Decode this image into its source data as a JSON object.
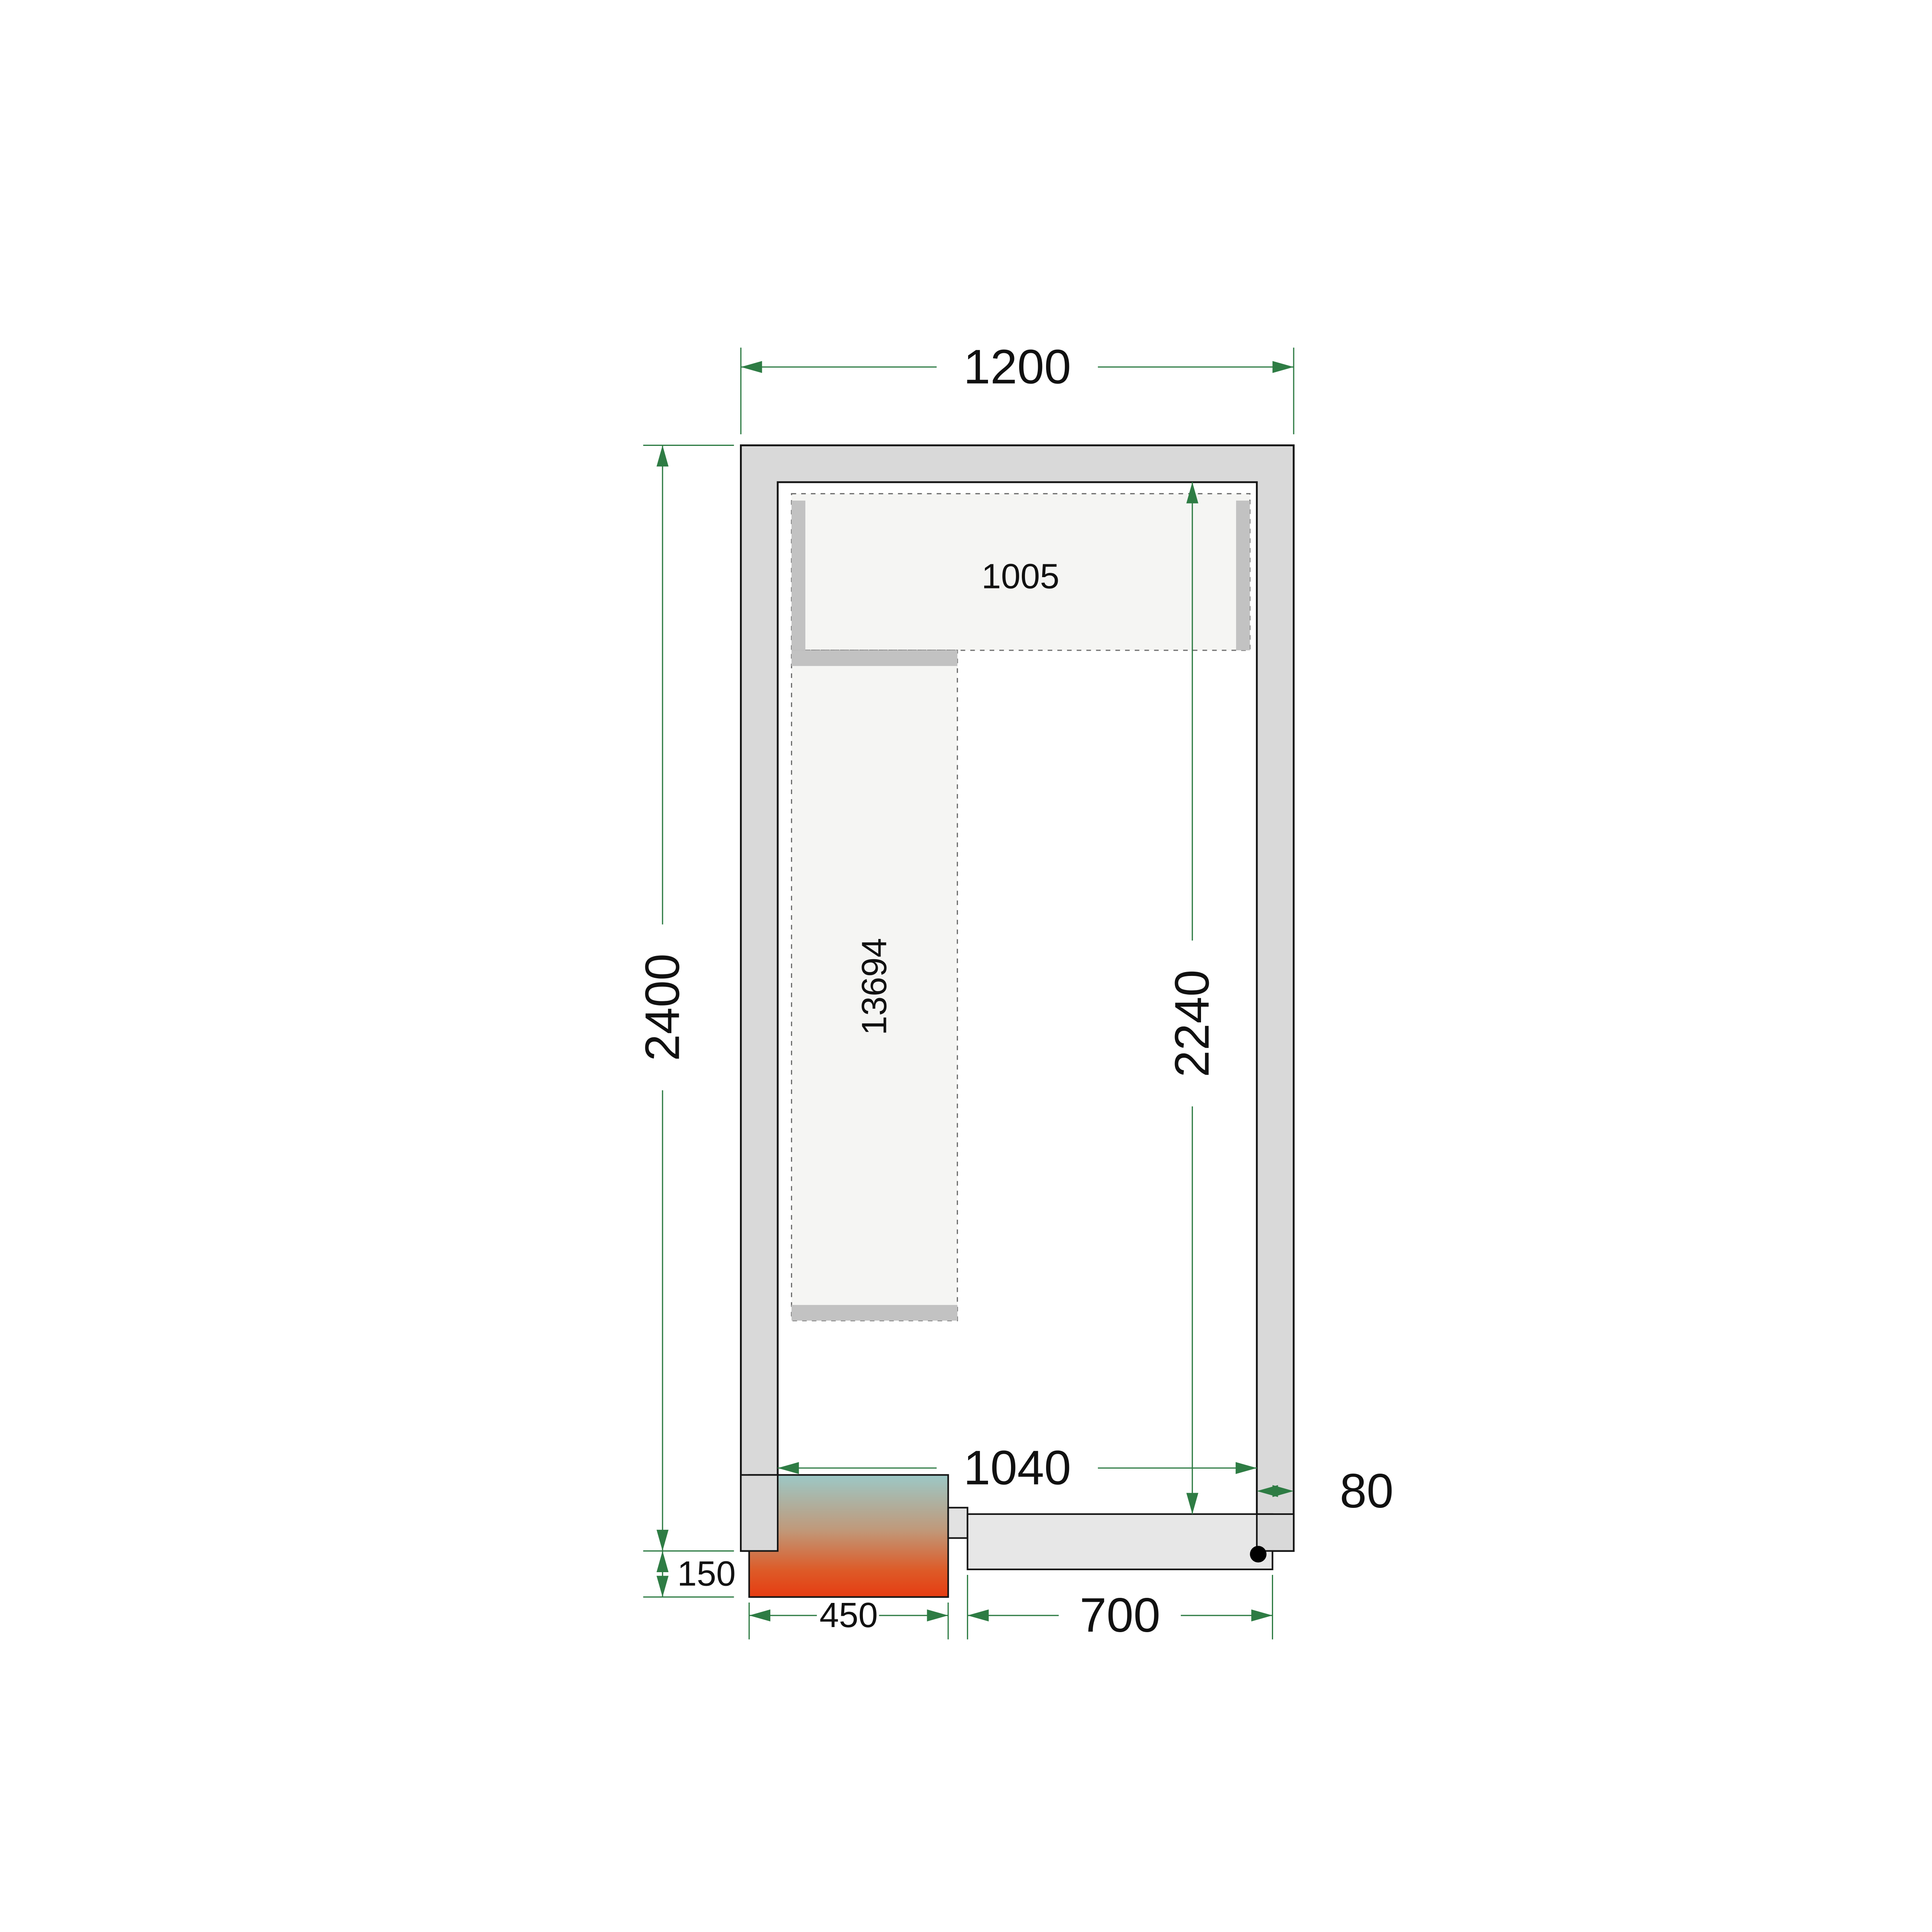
{
  "title": "Cold room floor plan drawing",
  "labels": {
    "outer_width": "1200",
    "outer_height": "2400",
    "inner_height": "2240",
    "inner_width": "1040",
    "top_shelf_width": "1005",
    "left_shelf_code": "13694",
    "cooler_protrusion": "150",
    "cooler_width": "450",
    "door_width": "700",
    "wall_thickness": "80"
  },
  "colors": {
    "dimension_green": "#2E7C44",
    "text": "#111111",
    "outline": "#151515",
    "wall_fill": "#D9D9D9",
    "shelf_fill": "#F5F5F3",
    "shelf_dash": "#6E6E6E",
    "bracket_fill": "#C2C2C2",
    "door_fill": "#E7E7E7",
    "step_fill": "#E2E2E2",
    "cooler_teal": "#9CC8C6",
    "cooler_tan": "#C0997A",
    "cooler_orange": "#DD5B28",
    "cooler_red": "#E63C12",
    "hinge_dot": "#000000"
  }
}
